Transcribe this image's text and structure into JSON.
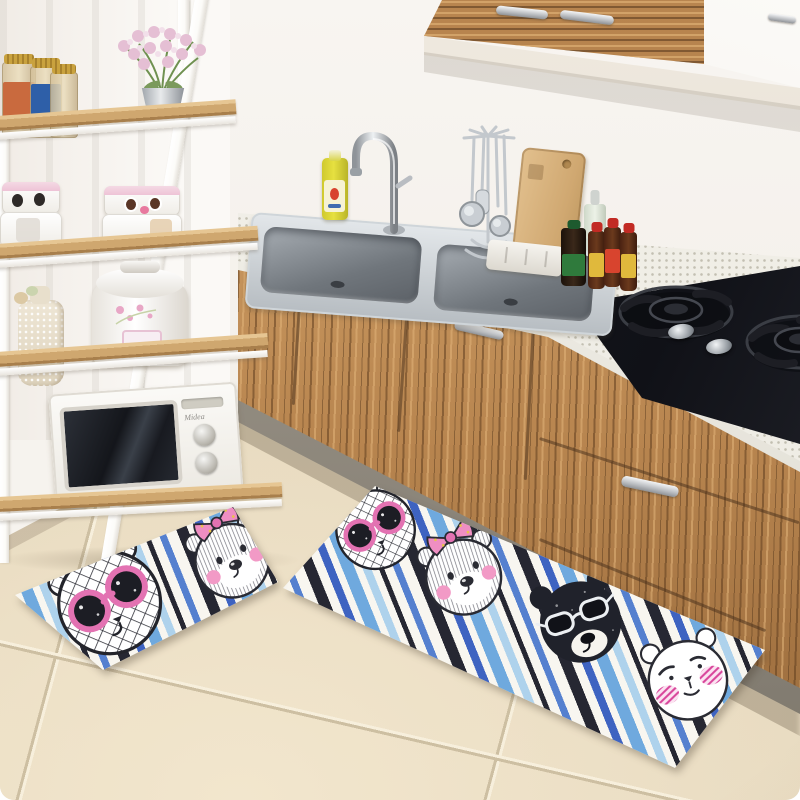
{
  "scene": {
    "setting": "bright kitchen corner with wood-grain cabinetry, white ladder shelf and tiled beige floor",
    "wall": "white wall with sheer curtain folds on the left",
    "floor": "large beige ceramic tiles"
  },
  "shelf_unit": {
    "frame": "white metal ladder frame with light oak boards",
    "shelves": [
      {
        "items": [
          "preserve-jar-red-label",
          "preserve-jar-blue-label",
          "glass-jar-gold-lid",
          "pink-blossom-bouquet-in-silver-pot"
        ]
      },
      {
        "items": [
          "lunchbox-stack-panda-eyes-pink-lid",
          "lunchbox-stack-surprised-face-pink-lid"
        ]
      },
      {
        "items": [
          "lace-covered-bottle-vase",
          "white-rice-cooker-floral-decal"
        ]
      },
      {
        "items": [
          "white-microwave-oven"
        ]
      }
    ]
  },
  "kitchen_run": {
    "wall_cabinets": [
      "zebra-wood-doors-silver-handles",
      "white-door-small-handle"
    ],
    "counter_items": [
      "yellow-dish-soap-bottle",
      "stainless-double-bowl-sink",
      "gooseneck-faucet",
      "utensil-hanger-with-ladles",
      "wooden-cutting-board",
      "white-utensil-stand",
      "clear-oil-bottle",
      "dark-soy-sauce-bottle",
      "sauce-bottle-red-cap-1",
      "sauce-bottle-red-cap-2",
      "sauce-bottle-red-cap-3",
      "black-glass-gas-cooktop-two-burners"
    ],
    "base_cabinets": "zebra-wood doors and drawers with silver bar handles, grey kick plate"
  },
  "appliances": {
    "microwave": {
      "brand": "Midea",
      "dials": 2
    },
    "rice_cooker": {
      "color": "white with pink floral decal"
    }
  },
  "mats": {
    "style": "striped fabric kitchen mats with cartoon bear faces",
    "stripe_colors": [
      "#f8f6f0",
      "#262732",
      "#3e63c1",
      "#5580cf",
      "#6fa9de",
      "#aed2ec"
    ],
    "small_mat": {
      "bears": [
        "crosshatch-bear-pink-sunglasses",
        "white-bear-pink-bow"
      ]
    },
    "runner_mat": {
      "bears": [
        "crosshatch-bear-pink-sunglasses",
        "white-bear-pink-bow",
        "black-bear-white-sunglasses",
        "white-bear-pink-striped-cheeks"
      ]
    }
  },
  "colors": {
    "wall": "#f6f3ee",
    "floor": "#e9dcc2",
    "grout-dark": "#cdbfa2",
    "grout-light": "#f7efdc",
    "shelf-wood": "#cfa76f",
    "shelf-wood-light": "#e6c693",
    "shelf-wood-dark": "#a87f4c",
    "frame-white": "#fcfbf8",
    "cab-wood": "#b8854f",
    "cab-wood-light": "#d8a96f",
    "counter": "#edebe3",
    "kick": "#a59e92",
    "cooktop": "#16181d",
    "mat-base": "#f8f6f0",
    "mat-black": "#262732",
    "mat-royal": "#3e63c1",
    "mat-sky": "#6fa9de",
    "mat-pale": "#aed2ec",
    "mat-blue": "#5580cf",
    "bear-pink": "#e372b2",
    "bear-pink-light": "#f29ac6",
    "bear-magenta": "#d8439a",
    "soap-yellow": "#e6e040"
  }
}
